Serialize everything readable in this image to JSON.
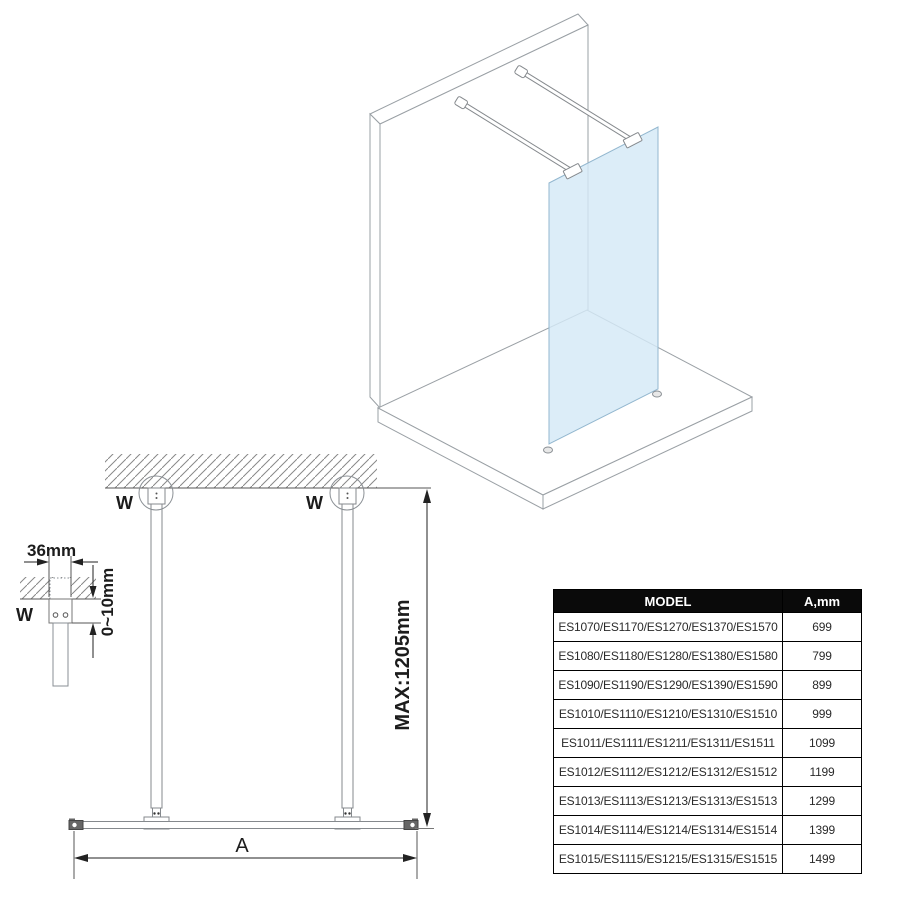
{
  "colors": {
    "glass_fill": "#d4e9f7",
    "glass_edge": "#93b7cf",
    "structure_line": "#9aa0a5",
    "hardware_line": "#85898d",
    "dimension_line": "#222222",
    "table_header_bg": "#0a0a0a",
    "table_header_text": "#ffffff",
    "table_border": "#000000"
  },
  "elevation": {
    "wall_marker_left": "W",
    "wall_marker_right": "W",
    "detail_wall_marker": "W",
    "dim_bracket_width": "36mm",
    "dim_ceiling_gap": "0~10mm",
    "dim_max_height": "MAX:1205mm",
    "dim_panel_width": "A"
  },
  "table": {
    "headers": [
      "MODEL",
      "A,mm"
    ],
    "rows": [
      {
        "model": "ES1070/ES1170/ES1270/ES1370/ES1570",
        "a": "699"
      },
      {
        "model": "ES1080/ES1180/ES1280/ES1380/ES1580",
        "a": "799"
      },
      {
        "model": "ES1090/ES1190/ES1290/ES1390/ES1590",
        "a": "899"
      },
      {
        "model": "ES1010/ES1110/ES1210/ES1310/ES1510",
        "a": "999"
      },
      {
        "model": "ES1011/ES1111/ES1211/ES1311/ES1511",
        "a": "1099"
      },
      {
        "model": "ES1012/ES1112/ES1212/ES1312/ES1512",
        "a": "1199"
      },
      {
        "model": "ES1013/ES1113/ES1213/ES1313/ES1513",
        "a": "1299"
      },
      {
        "model": "ES1014/ES1114/ES1214/ES1314/ES1514",
        "a": "1399"
      },
      {
        "model": "ES1015/ES1115/ES1215/ES1315/ES1515",
        "a": "1499"
      }
    ]
  }
}
